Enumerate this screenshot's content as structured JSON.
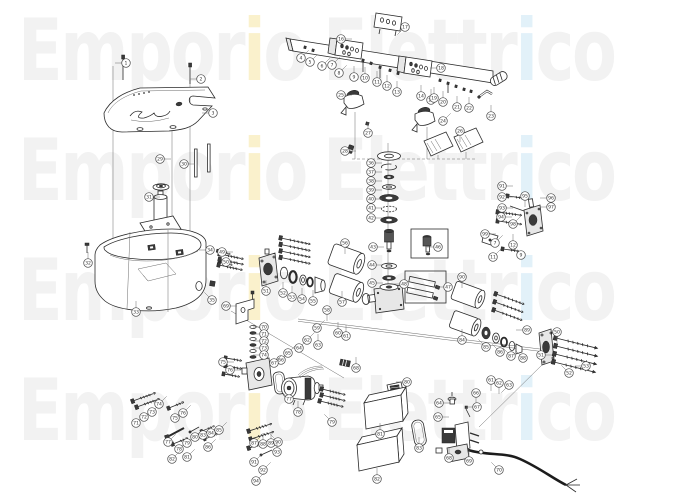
{
  "watermark": {
    "word1_pre": "Empor",
    "word1_i": "i",
    "word1_post": "o",
    "word2_pre": "Elettr",
    "word2_i": "i",
    "word2_post": "co",
    "gray": "#f2f2f2",
    "yellow": "#faf1cc",
    "blue": "#e2f1f9",
    "rows": 4
  },
  "diagram": {
    "line_color": "#2b2b2b",
    "balloon_stroke": "#4a4a4a",
    "callouts": [
      [
        126,
        63,
        "l",
        "1"
      ],
      [
        201,
        79,
        "l",
        "2"
      ],
      [
        213,
        113,
        "l",
        "3"
      ],
      [
        301,
        58,
        "ur",
        "4"
      ],
      [
        310,
        62,
        "ur",
        "5"
      ],
      [
        322,
        66,
        "ur",
        "6"
      ],
      [
        332,
        65,
        "ur",
        "7"
      ],
      [
        339,
        73,
        "ur",
        "8"
      ],
      [
        354,
        77,
        "u",
        "9"
      ],
      [
        365,
        78,
        "u",
        "10"
      ],
      [
        377,
        82,
        "u",
        "11"
      ],
      [
        387,
        86,
        "u",
        "12"
      ],
      [
        397,
        92,
        "u",
        "13"
      ],
      [
        421,
        96,
        "u",
        "14"
      ],
      [
        431,
        100,
        "u",
        "15"
      ],
      [
        341,
        39,
        "r",
        "16"
      ],
      [
        405,
        27,
        "dl",
        "17"
      ],
      [
        441,
        68,
        "l",
        "18"
      ],
      [
        434,
        98,
        "u",
        "19"
      ],
      [
        443,
        102,
        "u",
        "20"
      ],
      [
        457,
        107,
        "u",
        "21"
      ],
      [
        469,
        108,
        "u",
        "22"
      ],
      [
        491,
        116,
        "u",
        "23"
      ],
      [
        443,
        121,
        "ur",
        "24"
      ],
      [
        341,
        95,
        "r",
        "25"
      ],
      [
        460,
        131,
        "d",
        "26"
      ],
      [
        368,
        133,
        "u",
        "27"
      ],
      [
        345,
        151,
        "r",
        "28"
      ],
      [
        160,
        159,
        "r",
        "29"
      ],
      [
        184,
        164,
        "r",
        "30"
      ],
      [
        149,
        197,
        "r",
        "31"
      ],
      [
        88,
        263,
        "u",
        "32"
      ],
      [
        136,
        312,
        "u",
        "33"
      ],
      [
        210,
        250,
        "l",
        "34"
      ],
      [
        212,
        300,
        "ul",
        "35"
      ],
      [
        371,
        163,
        "r",
        "36"
      ],
      [
        371,
        172,
        "r",
        "37"
      ],
      [
        371,
        181,
        "r",
        "38"
      ],
      [
        371,
        190,
        "r",
        "39"
      ],
      [
        371,
        199,
        "r",
        "40"
      ],
      [
        371,
        208,
        "r",
        "41"
      ],
      [
        371,
        218,
        "r",
        "42"
      ],
      [
        373,
        247,
        "r",
        "43"
      ],
      [
        372,
        265,
        "r",
        "44"
      ],
      [
        372,
        283,
        "r",
        "45"
      ],
      [
        438,
        247,
        "l",
        "46"
      ],
      [
        448,
        287,
        "l",
        "47"
      ],
      [
        404,
        284,
        "l",
        "48"
      ],
      [
        222,
        252,
        "r",
        "49"
      ],
      [
        226,
        262,
        "r",
        "50"
      ],
      [
        266,
        291,
        "u",
        "51"
      ],
      [
        283,
        293,
        "u",
        "52"
      ],
      [
        292,
        297,
        "u",
        "53"
      ],
      [
        302,
        299,
        "u",
        "54"
      ],
      [
        313,
        301,
        "u",
        "55"
      ],
      [
        345,
        243,
        "d",
        "56"
      ],
      [
        342,
        302,
        "u",
        "57"
      ],
      [
        327,
        310,
        "d",
        "58"
      ],
      [
        317,
        328,
        "ur",
        "59"
      ],
      [
        338,
        333,
        "u",
        "60"
      ],
      [
        346,
        336,
        "u",
        "61"
      ],
      [
        307,
        340,
        "ur",
        "62"
      ],
      [
        318,
        345,
        "u",
        "63"
      ],
      [
        299,
        348,
        "ur",
        "64"
      ],
      [
        288,
        353,
        "ur",
        "65"
      ],
      [
        281,
        360,
        "ur",
        "66"
      ],
      [
        274,
        363,
        "ur",
        "67"
      ],
      [
        356,
        368,
        "u",
        "68"
      ],
      [
        226,
        306,
        "r",
        "69"
      ],
      [
        264,
        327,
        "l",
        "70"
      ],
      [
        264,
        334,
        "l",
        "71"
      ],
      [
        264,
        341,
        "l",
        "72"
      ],
      [
        264,
        348,
        "l",
        "73"
      ],
      [
        264,
        355,
        "l",
        "74"
      ],
      [
        223,
        362,
        "r",
        "75"
      ],
      [
        230,
        370,
        "r",
        "76"
      ],
      [
        289,
        399,
        "ul",
        "77"
      ],
      [
        298,
        412,
        "u",
        "78"
      ],
      [
        332,
        422,
        "ul",
        "79"
      ],
      [
        407,
        382,
        "l",
        "80"
      ],
      [
        380,
        434,
        "u",
        "81"
      ],
      [
        377,
        479,
        "u",
        "82"
      ],
      [
        419,
        448,
        "u",
        "83"
      ],
      [
        462,
        340,
        "u",
        "84"
      ],
      [
        486,
        347,
        "ul",
        "85"
      ],
      [
        500,
        352,
        "ul",
        "86"
      ],
      [
        511,
        356,
        "ul",
        "87"
      ],
      [
        523,
        358,
        "ul",
        "88"
      ],
      [
        527,
        330,
        "l",
        "89"
      ],
      [
        462,
        277,
        "d",
        "90"
      ],
      [
        502,
        186,
        "r",
        "91"
      ],
      [
        502,
        197,
        "r",
        "92"
      ],
      [
        502,
        208,
        "r",
        "93"
      ],
      [
        501,
        217,
        "r",
        "94"
      ],
      [
        525,
        196,
        "d",
        "95"
      ],
      [
        551,
        198,
        "l",
        "96"
      ],
      [
        551,
        207,
        "l",
        "97"
      ],
      [
        513,
        224,
        "ur",
        "98"
      ],
      [
        485,
        234,
        "r",
        "99"
      ],
      [
        495,
        243,
        "ur",
        "7"
      ],
      [
        513,
        245,
        "u",
        "12"
      ],
      [
        521,
        255,
        "ul",
        "9"
      ],
      [
        493,
        257,
        "ur",
        "11"
      ],
      [
        557,
        332,
        "d",
        "50"
      ],
      [
        541,
        355,
        "r",
        "51"
      ],
      [
        569,
        373,
        "ul",
        "52"
      ],
      [
        586,
        366,
        "l",
        "53"
      ],
      [
        491,
        380,
        "d",
        "61"
      ],
      [
        499,
        383,
        "d",
        "62"
      ],
      [
        509,
        385,
        "dl",
        "63"
      ],
      [
        439,
        403,
        "r",
        "64"
      ],
      [
        438,
        417,
        "r",
        "65"
      ],
      [
        476,
        393,
        "d",
        "66"
      ],
      [
        477,
        407,
        "l",
        "67"
      ],
      [
        449,
        458,
        "u",
        "68"
      ],
      [
        469,
        461,
        "u",
        "69"
      ],
      [
        499,
        470,
        "ul",
        "70"
      ],
      [
        136,
        423,
        "ur",
        "71"
      ],
      [
        144,
        417,
        "ur",
        "72"
      ],
      [
        152,
        412,
        "ur",
        "73"
      ],
      [
        159,
        404,
        "ur",
        "74"
      ],
      [
        175,
        418,
        "ur",
        "75"
      ],
      [
        183,
        413,
        "ur",
        "76"
      ],
      [
        168,
        442,
        "ur",
        "77"
      ],
      [
        179,
        449,
        "ur",
        "78"
      ],
      [
        187,
        443,
        "ur",
        "79"
      ],
      [
        195,
        437,
        "ur",
        "80"
      ],
      [
        187,
        457,
        "ur",
        "81"
      ],
      [
        172,
        459,
        "ur",
        "82"
      ],
      [
        203,
        435,
        "ur",
        "83"
      ],
      [
        211,
        433,
        "ur",
        "84"
      ],
      [
        219,
        430,
        "ur",
        "85"
      ],
      [
        208,
        447,
        "ur",
        "86"
      ],
      [
        254,
        443,
        "ur",
        "87"
      ],
      [
        263,
        444,
        "u",
        "88"
      ],
      [
        271,
        443,
        "u",
        "89"
      ],
      [
        278,
        442,
        "ul",
        "90"
      ],
      [
        254,
        462,
        "ur",
        "91"
      ],
      [
        263,
        470,
        "ur",
        "92"
      ],
      [
        277,
        452,
        "u",
        "93"
      ],
      [
        256,
        481,
        "ur",
        "94"
      ]
    ]
  }
}
